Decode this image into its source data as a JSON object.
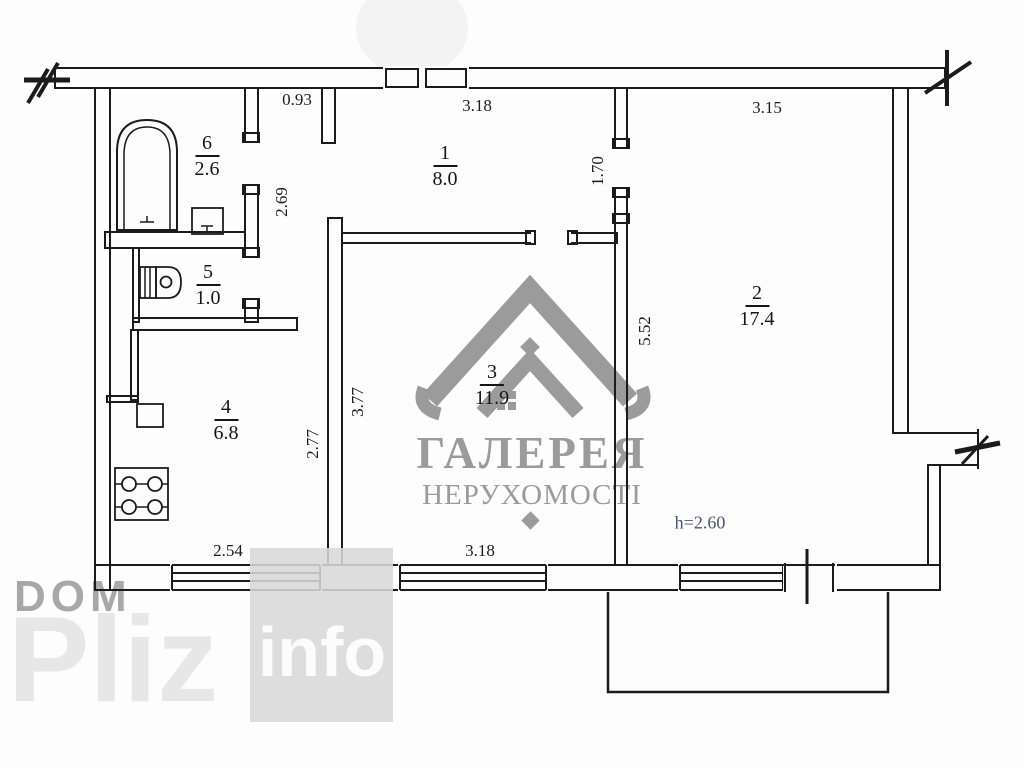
{
  "colors": {
    "line": "#1b1b1b",
    "watermark_gray": "#9b9b9b",
    "height_note": "#4a5470"
  },
  "watermarks": {
    "logo_title": "ГАЛЕРЕЯ",
    "logo_subtitle": "НЕРУХОМОСТІ",
    "dom": "DOM",
    "pliz": "Pliz",
    "info": "info"
  },
  "plan": {
    "rooms": [
      {
        "number": "1",
        "area": "8.0"
      },
      {
        "number": "2",
        "area": "17.4"
      },
      {
        "number": "3",
        "area": "11.9"
      },
      {
        "number": "4",
        "area": "6.8"
      },
      {
        "number": "5",
        "area": "1.0"
      },
      {
        "number": "6",
        "area": "2.6"
      }
    ],
    "dims": {
      "corridor_width": "0.93",
      "hall_width": "3.18",
      "room2_width": "3.15",
      "corridor_length": "2.69",
      "hall_room2_wall": "1.70",
      "room2_depth": "5.52",
      "room3_depth": "3.77",
      "kitchen_depth": "2.77",
      "kitchen_width": "2.54",
      "room3_width": "3.18",
      "ceiling_height": "h=2.60"
    }
  }
}
